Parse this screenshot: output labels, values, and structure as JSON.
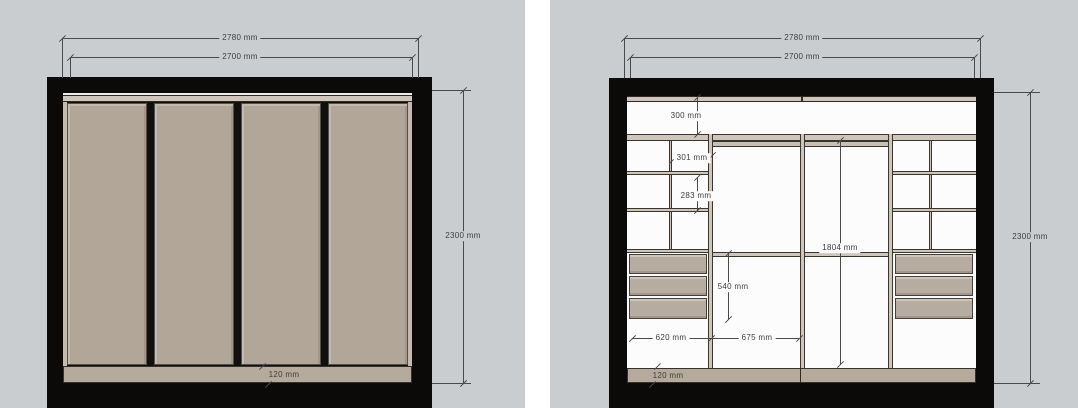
{
  "app": {
    "description": "Two wardrobe elevation drawings: closed sliding-door view and internal layout view"
  },
  "colors": {
    "panel_background": "#c9cdd0",
    "gutter": "#ffffff",
    "frame_black": "#0b0a09",
    "door_taupe": "#b2a699",
    "plinth_beige": "#b5aa9c",
    "drawer_front": "#b6aca0",
    "interior_white": "#fcfcfc",
    "dimension_line": "#4a4a4a",
    "dimension_text": "#3e3e3e"
  },
  "left_panel": {
    "dim_outer_width": "2780 mm",
    "dim_inner_width": "2700 mm",
    "dim_height": "2300 mm",
    "dim_plinth_height": "120 mm"
  },
  "right_panel": {
    "dim_outer_width": "2780 mm",
    "dim_inner_width": "2700 mm",
    "dim_height": "2300 mm",
    "dim_plinth_height": "120 mm",
    "dim_top_shelf_height": "300 mm",
    "dim_upper_cubby_height": "301 mm",
    "dim_lower_cubby_height": "283 mm",
    "dim_hanging_height": "1804 mm",
    "dim_drawer_stack_height": "540 mm",
    "dim_left_bay_width": "620 mm",
    "dim_middle_bay_width": "675 mm"
  }
}
